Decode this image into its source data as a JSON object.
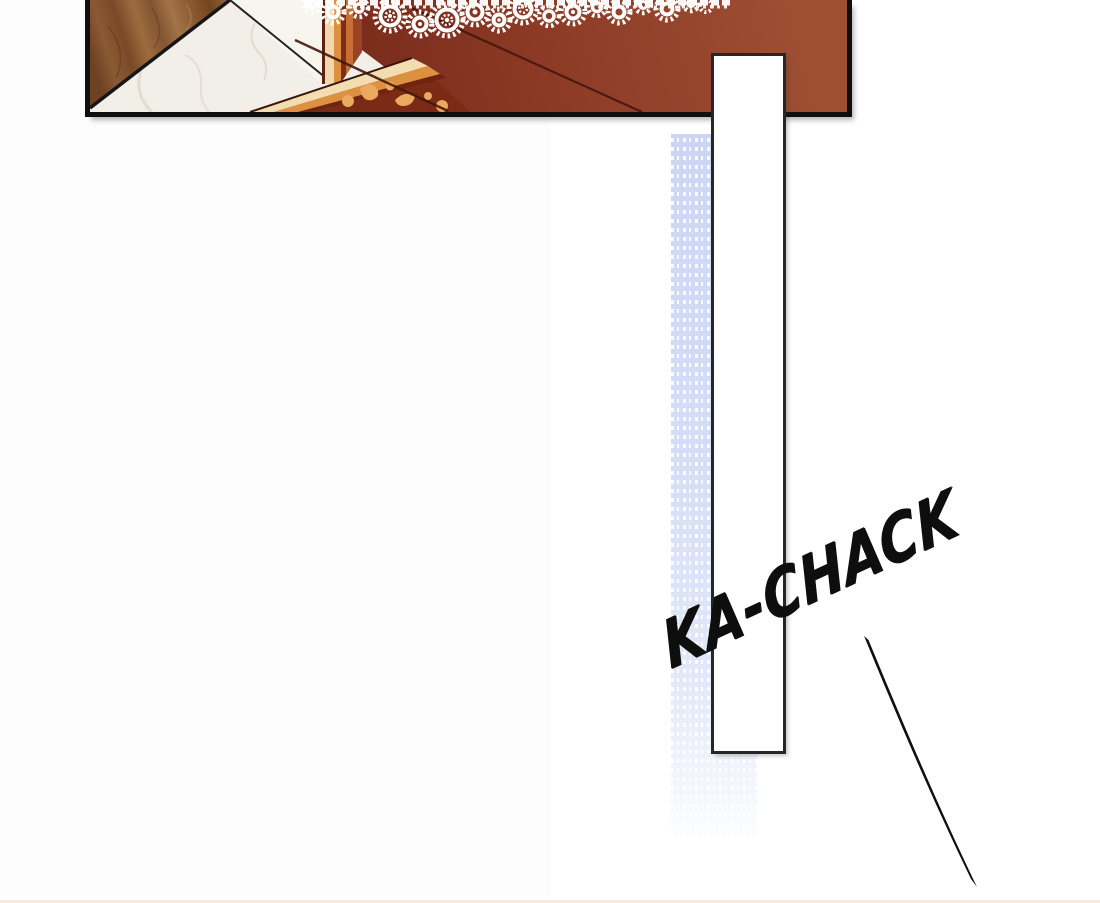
{
  "scene": {
    "kind": "comic-panel-page"
  },
  "sfx": {
    "text": "KA-CHACK"
  },
  "colors": {
    "background": "#ffffff",
    "background_left": "#fdfdfd",
    "panel_border": "#0f0f0f",
    "marble": "#f2efe8",
    "marble_vein": "#ded7cb",
    "maroon_light": "#9d4e33",
    "maroon_mid": "#8c3a25",
    "maroon_dark": "#78291a",
    "wood_mid": "#8a5a34",
    "wood_dark": "#6e4123",
    "wood_light": "#a37447",
    "gold_cream": "#f2ddb0",
    "gold_orange": "#dd9040",
    "gold_ornament": "#eaa95e",
    "trim_maroon": "#6f2412",
    "lace_white": "#ffffff",
    "strip_blue": "#ccd6f4",
    "bar_white": "#ffffff",
    "bar_border": "#262626",
    "sfx_color": "#0e0e0e",
    "speedline_color": "#101010",
    "bottom_tint": "#f7e3d8"
  }
}
